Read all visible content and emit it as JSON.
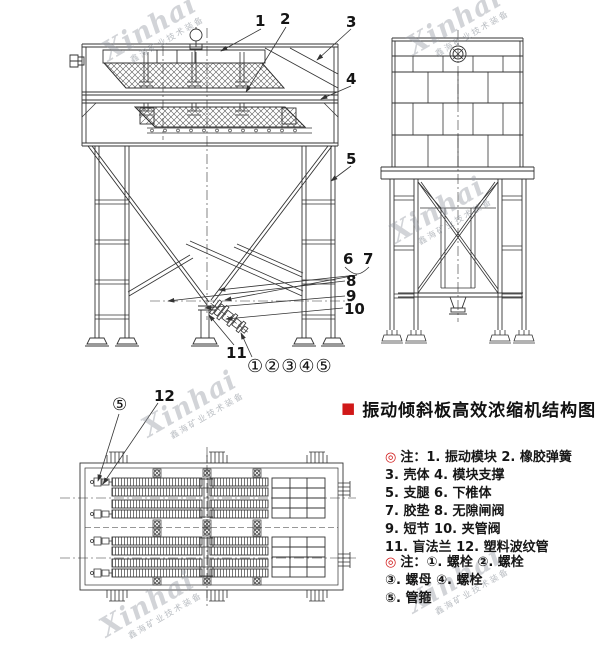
{
  "colors": {
    "accent_red": "#d01818",
    "line": "#333333",
    "watermark_gray": "#9499a3"
  },
  "watermark": {
    "name": "Xinhai",
    "subtitle": "鑫海矿业技术装备"
  },
  "title": {
    "marker": "■",
    "text": "振动倾斜板高效浓缩机结构图"
  },
  "notes_parts": {
    "marker": "◎",
    "lines": [
      "注：1. 振动模块  2. 橡胶弹簧",
      "3. 壳体  4. 模块支撑",
      "5. 支腿  6. 下椎体",
      "7. 胶垫  8. 无隙闸阀",
      "9. 短节  10. 夹管阀",
      "11. 盲法兰  12. 塑料波纹管"
    ]
  },
  "notes_fasteners": {
    "marker": "◎",
    "lines": [
      "注：①. 螺栓 ②. 螺栓",
      "③. 螺母 ④. 螺栓",
      "⑤. 管箍"
    ]
  },
  "front_view": {
    "callouts": [
      "1",
      "2",
      "3",
      "4",
      "5",
      "6",
      "7",
      "8",
      "9",
      "10",
      "11"
    ],
    "fastener_row": "①②③④⑤"
  },
  "plan_view": {
    "callouts": {
      "clamp": "⑤",
      "bellows": "12"
    }
  }
}
